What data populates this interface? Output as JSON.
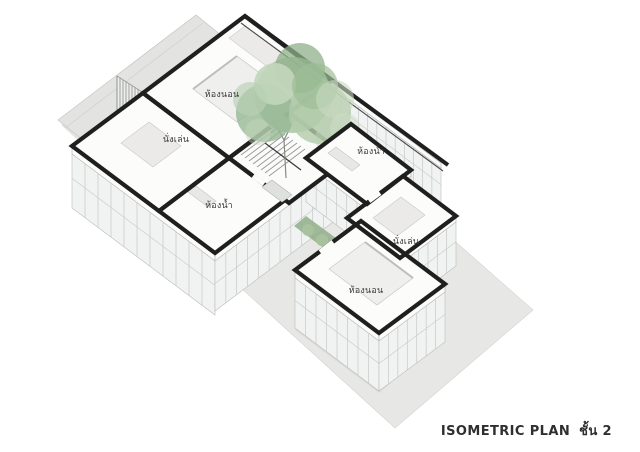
{
  "caption": {
    "title": "ISOMETRIC PLAN",
    "floor": "ชั้น 2"
  },
  "rooms": {
    "bedroom_upper": "ห้องนอน",
    "living_upper": "นั่งเล่น",
    "bath_upper": "ห้องน้ำ",
    "bath_lower": "ห้องน้ำ",
    "living_lower": "นั่งเล่น",
    "bedroom_lower": "ห้องนอน"
  },
  "colors": {
    "ink": "#1f1f1f",
    "ground": "#e6e6e4",
    "glass": "#f1f3f2",
    "foliage": "#a8c4a2",
    "label": "#3a3a3a"
  }
}
